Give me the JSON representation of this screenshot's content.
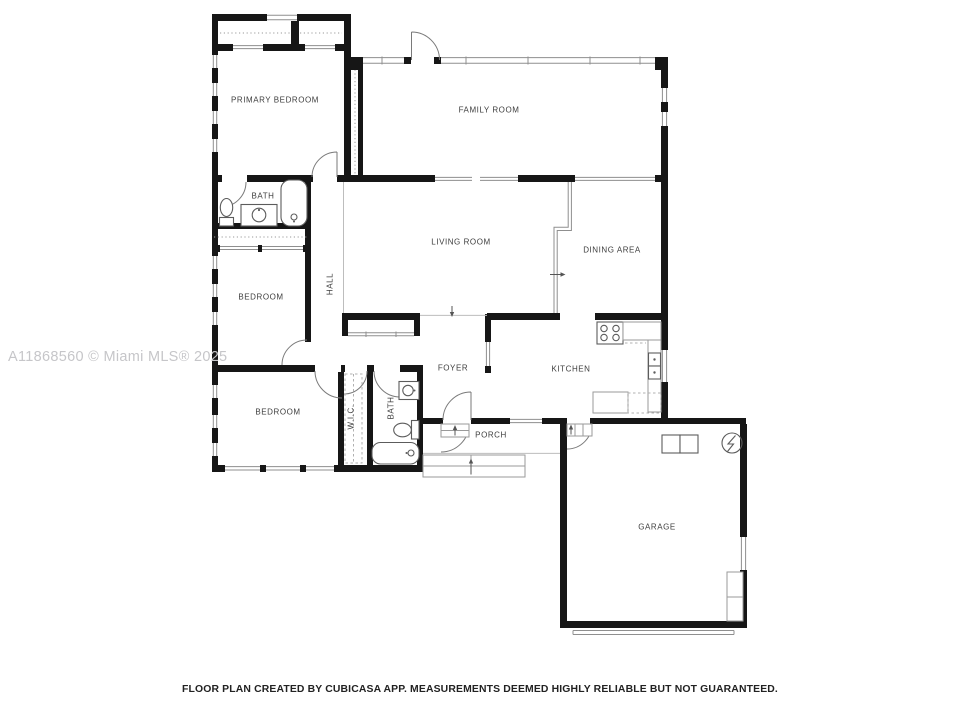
{
  "watermark": "A11868560 © Miami MLS® 2025",
  "disclaimer": "FLOOR PLAN CREATED BY CUBICASA APP. MEASUREMENTS DEEMED HIGHLY RELIABLE BUT NOT GUARANTEED.",
  "rooms": [
    {
      "id": "primary-bedroom",
      "label": "PRIMARY BEDROOM"
    },
    {
      "id": "family-room",
      "label": "FAMILY ROOM"
    },
    {
      "id": "bath-primary",
      "label": "BATH"
    },
    {
      "id": "living-room",
      "label": "LIVING ROOM"
    },
    {
      "id": "dining-area",
      "label": "DINING AREA"
    },
    {
      "id": "bedroom-middle",
      "label": "BEDROOM"
    },
    {
      "id": "hall",
      "label": "HALL"
    },
    {
      "id": "foyer",
      "label": "FOYER"
    },
    {
      "id": "kitchen",
      "label": "KITCHEN"
    },
    {
      "id": "bedroom-bottom",
      "label": "BEDROOM"
    },
    {
      "id": "wic",
      "label": "W.I.C."
    },
    {
      "id": "bath-second",
      "label": "BATH"
    },
    {
      "id": "porch",
      "label": "PORCH"
    },
    {
      "id": "garage",
      "label": "GARAGE"
    }
  ],
  "fixture_names": [
    "closet",
    "toilet",
    "sink-vanity",
    "bathtub",
    "stove",
    "kitchen-sink",
    "kitchen-counter",
    "wardrobe",
    "washer-dryer",
    "electrical-panel",
    "storage-shelf",
    "garage-door",
    "steps",
    "door-swing",
    "window"
  ],
  "colors": {
    "background": "#ffffff",
    "wall": "#161616",
    "thin_line": "#8f8f8f",
    "fixture": "#5c5c5c",
    "label": "#3d3d3d",
    "watermark": "#c6c6c9",
    "disclaimer": "#222222"
  }
}
